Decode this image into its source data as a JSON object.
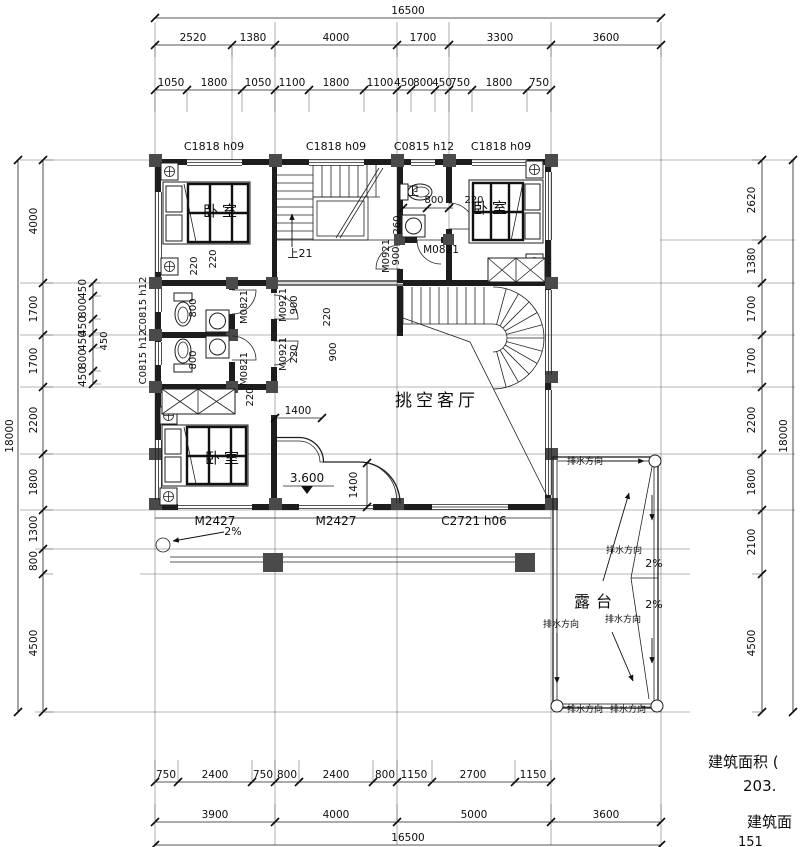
{
  "sheet": {
    "type": "architectural-floor-plan",
    "notes": [
      {
        "n": "note-building-area-1",
        "t": "建筑面积 (",
        "x": 708,
        "y": 767,
        "fs": 15,
        "a": "s"
      },
      {
        "n": "note-building-area-2",
        "t": "203.",
        "x": 743,
        "y": 791,
        "fs": 15,
        "a": "s"
      },
      {
        "n": "note-building-area-3",
        "t": "建筑面",
        "x": 747,
        "y": 827,
        "fs": 15,
        "a": "s"
      },
      {
        "n": "note-building-area-4",
        "t": "151",
        "x": 738,
        "y": 846,
        "fs": 13,
        "a": "s"
      }
    ]
  },
  "plan": {
    "dim_rows": [
      {
        "id": "top-total",
        "y": 18,
        "x1": 155,
        "x2": 661,
        "ticks": [
          155,
          661
        ],
        "labels": [
          {
            "t": "16500",
            "x": 408
          }
        ]
      },
      {
        "id": "top-main",
        "y": 45,
        "x1": 155,
        "x2": 661,
        "ext": 12,
        "ticks": [
          155,
          232,
          275,
          397,
          449,
          551,
          661
        ],
        "labels": [
          {
            "t": "2520",
            "x": 193
          },
          {
            "t": "1380",
            "x": 253
          },
          {
            "t": "4000",
            "x": 336
          },
          {
            "t": "1700",
            "x": 423
          },
          {
            "t": "3300",
            "x": 500
          },
          {
            "t": "3600",
            "x": 606
          }
        ]
      },
      {
        "id": "top-detail",
        "y": 90,
        "x1": 155,
        "x2": 551,
        "ext": 22,
        "ticks": [
          155,
          187,
          242,
          275,
          309,
          364,
          397,
          411,
          435,
          449,
          472,
          527,
          551
        ],
        "labels": [
          {
            "t": "1050",
            "x": 171
          },
          {
            "t": "1800",
            "x": 214
          },
          {
            "t": "1050",
            "x": 258
          },
          {
            "t": "1100",
            "x": 292
          },
          {
            "t": "1800",
            "x": 336
          },
          {
            "t": "1100",
            "x": 380
          },
          {
            "t": "450",
            "x": 404
          },
          {
            "t": "800",
            "x": 423
          },
          {
            "t": "450",
            "x": 442
          },
          {
            "t": "750",
            "x": 460
          },
          {
            "t": "1800",
            "x": 499
          },
          {
            "t": "750",
            "x": 539
          }
        ]
      },
      {
        "id": "bath-dim",
        "y": 208,
        "x1": 403,
        "x2": 453,
        "ticks": [
          403,
          427,
          449
        ],
        "labels": []
      },
      {
        "id": "dim-1400-h",
        "y": 418,
        "x1": 275,
        "x2": 322,
        "ticks": [
          275,
          322
        ],
        "labels": []
      },
      {
        "id": "bottom-detail",
        "y": 782,
        "x1": 155,
        "x2": 551,
        "ext": -22,
        "ticks": [
          155,
          178,
          252,
          275,
          299,
          373,
          397,
          432,
          515,
          551
        ],
        "labels": [
          {
            "t": "750",
            "x": 166
          },
          {
            "t": "2400",
            "x": 215
          },
          {
            "t": "750",
            "x": 263
          },
          {
            "t": "800",
            "x": 287
          },
          {
            "t": "2400",
            "x": 336
          },
          {
            "t": "800",
            "x": 385
          },
          {
            "t": "1150",
            "x": 414
          },
          {
            "t": "2700",
            "x": 473
          },
          {
            "t": "1150",
            "x": 533
          }
        ]
      },
      {
        "id": "bottom-main",
        "y": 822,
        "x1": 155,
        "x2": 661,
        "ext": -18,
        "ticks": [
          155,
          275,
          397,
          551,
          661
        ],
        "labels": [
          {
            "t": "3900",
            "x": 215
          },
          {
            "t": "4000",
            "x": 336
          },
          {
            "t": "5000",
            "x": 474
          },
          {
            "t": "3600",
            "x": 606
          }
        ]
      },
      {
        "id": "bottom-total",
        "y": 845,
        "x1": 155,
        "x2": 661,
        "ticks": [
          155,
          661
        ],
        "labels": [
          {
            "t": "16500",
            "x": 408
          }
        ]
      }
    ],
    "dim_cols": [
      {
        "id": "left-total",
        "x": 18,
        "tx": 13,
        "y1": 160,
        "y2": 712,
        "ticks": [
          160,
          712
        ],
        "labels": [
          {
            "t": "18000",
            "y": 436
          }
        ]
      },
      {
        "id": "left-chain",
        "x": 43,
        "tx": 37,
        "y1": 160,
        "y2": 712,
        "ext": 10,
        "ticks": [
          160,
          283,
          335,
          387,
          454,
          510,
          549,
          574,
          712
        ],
        "labels": [
          {
            "t": "4000",
            "y": 221
          },
          {
            "t": "1700",
            "y": 309
          },
          {
            "t": "1700",
            "y": 361
          },
          {
            "t": "2200",
            "y": 420
          },
          {
            "t": "1800",
            "y": 482
          },
          {
            "t": "1300",
            "y": 529
          },
          {
            "t": "800",
            "y": 561
          },
          {
            "t": "4500",
            "y": 643
          }
        ]
      },
      {
        "id": "left-inner",
        "x": 93,
        "tx": 86,
        "y1": 283,
        "y2": 384,
        "ext": 8,
        "ticks": [
          283,
          296,
          319,
          333,
          348,
          371,
          384
        ],
        "labels": [
          {
            "t": "450",
            "y": 289
          },
          {
            "t": "800",
            "y": 308
          },
          {
            "t": "450",
            "y": 326
          },
          {
            "t": "450",
            "y": 341
          },
          {
            "t": "800",
            "y": 359
          },
          {
            "t": "450",
            "y": 377
          }
        ]
      },
      {
        "id": "right-chain",
        "x": 762,
        "tx": 755,
        "y1": 160,
        "y2": 712,
        "ext": -10,
        "ticks": [
          160,
          240,
          283,
          335,
          387,
          454,
          510,
          574,
          712
        ],
        "labels": [
          {
            "t": "2620",
            "y": 200
          },
          {
            "t": "1380",
            "y": 261
          },
          {
            "t": "1700",
            "y": 309
          },
          {
            "t": "1700",
            "y": 361
          },
          {
            "t": "2200",
            "y": 420
          },
          {
            "t": "1800",
            "y": 482
          },
          {
            "t": "2100",
            "y": 542
          },
          {
            "t": "4500",
            "y": 643
          }
        ]
      },
      {
        "id": "right-total",
        "x": 793,
        "tx": 787,
        "y1": 160,
        "y2": 712,
        "ticks": [
          160,
          712
        ],
        "labels": [
          {
            "t": "18000",
            "y": 436
          }
        ]
      },
      {
        "id": "dim-1400-v",
        "x": 367,
        "tx": 360,
        "y1": 463,
        "y2": 507,
        "ticks": [
          463,
          507
        ],
        "labels": []
      }
    ],
    "labels": [
      {
        "n": "window-label",
        "t": "C1818 h09",
        "x": 214,
        "y": 150,
        "fs": 11
      },
      {
        "n": "window-label",
        "t": "C1818 h09",
        "x": 336,
        "y": 150,
        "fs": 11
      },
      {
        "n": "window-label",
        "t": "C0815 h12",
        "x": 424,
        "y": 150,
        "fs": 11
      },
      {
        "n": "window-label",
        "t": "C1818 h09",
        "x": 501,
        "y": 150,
        "fs": 11
      },
      {
        "n": "room-label-bedroom-topleft",
        "t": "卧室",
        "x": 222,
        "y": 216,
        "fs": 15,
        "ls": 4
      },
      {
        "n": "room-label-bedroom-topright",
        "t": "卧室",
        "x": 492,
        "y": 213,
        "fs": 15,
        "ls": 4
      },
      {
        "n": "room-label-bedroom-bottomleft",
        "t": "卧室",
        "x": 224,
        "y": 463,
        "fs": 15,
        "ls": 4
      },
      {
        "n": "room-label-bath",
        "t": "卫",
        "x": 413,
        "y": 195,
        "fs": 12
      },
      {
        "n": "room-label-living-void",
        "t": "挑空客厅",
        "x": 437,
        "y": 406,
        "fs": 17,
        "ls": 4
      },
      {
        "n": "room-label-terrace",
        "t": "露台",
        "x": 596,
        "y": 607,
        "fs": 16,
        "ls": 6
      },
      {
        "n": "stair-up-label",
        "t": "上21",
        "x": 300,
        "y": 257,
        "fs": 11
      },
      {
        "n": "door-label",
        "t": "M2427",
        "x": 215,
        "y": 525,
        "fs": 12
      },
      {
        "n": "door-label",
        "t": "M2427",
        "x": 336,
        "y": 525,
        "fs": 12
      },
      {
        "n": "window-label",
        "t": "C2721 h06",
        "x": 474,
        "y": 525,
        "fs": 12
      },
      {
        "n": "window-label",
        "t": "C0815 h12",
        "x": 146,
        "y": 304,
        "r": -90,
        "fs": 10
      },
      {
        "n": "window-label",
        "t": "C0815 h12",
        "x": 146,
        "y": 357,
        "r": -90,
        "fs": 10
      },
      {
        "n": "dim-inner",
        "t": "220",
        "x": 216,
        "y": 259,
        "r": -90,
        "fs": 10
      },
      {
        "n": "dim-inner",
        "t": "220",
        "x": 197,
        "y": 266,
        "r": -90,
        "fs": 10
      },
      {
        "n": "dim-inner",
        "t": "800",
        "x": 196,
        "y": 308,
        "r": -90,
        "fs": 10
      },
      {
        "n": "dim-inner",
        "t": "800",
        "x": 196,
        "y": 360,
        "r": -90,
        "fs": 10
      },
      {
        "n": "dim-inner",
        "t": "220",
        "x": 253,
        "y": 397,
        "r": -90,
        "fs": 10
      },
      {
        "n": "door-label",
        "t": "M0821",
        "x": 247,
        "y": 307,
        "r": -90,
        "fs": 10
      },
      {
        "n": "door-label",
        "t": "M0821",
        "x": 247,
        "y": 369,
        "r": -90,
        "fs": 10
      },
      {
        "n": "door-label",
        "t": "M0921",
        "x": 286,
        "y": 305,
        "r": -90,
        "fs": 10
      },
      {
        "n": "dim-inner",
        "t": "900",
        "x": 297,
        "y": 305,
        "r": -90,
        "fs": 10
      },
      {
        "n": "door-label",
        "t": "M0921",
        "x": 286,
        "y": 354,
        "r": -90,
        "fs": 10
      },
      {
        "n": "dim-inner",
        "t": "220",
        "x": 297,
        "y": 354,
        "r": -90,
        "fs": 10
      },
      {
        "n": "dim-inner",
        "t": "220",
        "x": 330,
        "y": 317,
        "r": -90,
        "fs": 10
      },
      {
        "n": "dim-inner",
        "t": "900",
        "x": 336,
        "y": 352,
        "r": -90,
        "fs": 10
      },
      {
        "n": "dim-inner",
        "t": "260",
        "x": 400,
        "y": 225,
        "r": -90,
        "fs": 10
      },
      {
        "n": "door-label",
        "t": "M0921",
        "x": 389,
        "y": 256,
        "r": -90,
        "fs": 10
      },
      {
        "n": "dim-inner",
        "t": "900",
        "x": 399,
        "y": 256,
        "r": -90,
        "fs": 10
      },
      {
        "n": "dim-inner",
        "t": "450",
        "x": 107,
        "y": 341,
        "r": -90,
        "fs": 10
      },
      {
        "n": "dim-inner",
        "t": "800",
        "x": 434,
        "y": 203,
        "fs": 10
      },
      {
        "n": "dim-inner",
        "t": "220",
        "x": 474,
        "y": 203,
        "fs": 10
      },
      {
        "n": "door-label",
        "t": "M0821",
        "x": 441,
        "y": 253,
        "fs": 10.5
      },
      {
        "n": "dim-inner",
        "t": "1400",
        "x": 298,
        "y": 414,
        "fs": 10.5
      },
      {
        "n": "dim-inner",
        "t": "1400",
        "x": 357,
        "y": 485,
        "r": -90,
        "fs": 10.5
      },
      {
        "n": "elevation-label",
        "t": "3.600",
        "x": 307,
        "y": 482,
        "fs": 12
      },
      {
        "n": "slope-label",
        "t": "2%",
        "x": 233,
        "y": 535,
        "fs": 11
      },
      {
        "n": "slope-label",
        "t": "2%",
        "x": 654,
        "y": 567,
        "fs": 11
      },
      {
        "n": "slope-label",
        "t": "2%",
        "x": 654,
        "y": 608,
        "fs": 11
      },
      {
        "n": "drain-direction-label",
        "t": "排水方向",
        "x": 585,
        "y": 464,
        "fs": 9
      },
      {
        "n": "drain-direction-label",
        "t": "排水方向",
        "x": 624,
        "y": 553,
        "fs": 9
      },
      {
        "n": "drain-direction-label",
        "t": "排水方向",
        "x": 561,
        "y": 627,
        "fs": 9
      },
      {
        "n": "drain-direction-label",
        "t": "排水方向",
        "x": 623,
        "y": 622,
        "fs": 9
      },
      {
        "n": "drain-direction-label",
        "t": "排水方向",
        "x": 585,
        "y": 712,
        "fs": 9
      },
      {
        "n": "drain-direction-label",
        "t": "排水方向",
        "x": 628,
        "y": 712,
        "fs": 9
      }
    ]
  }
}
